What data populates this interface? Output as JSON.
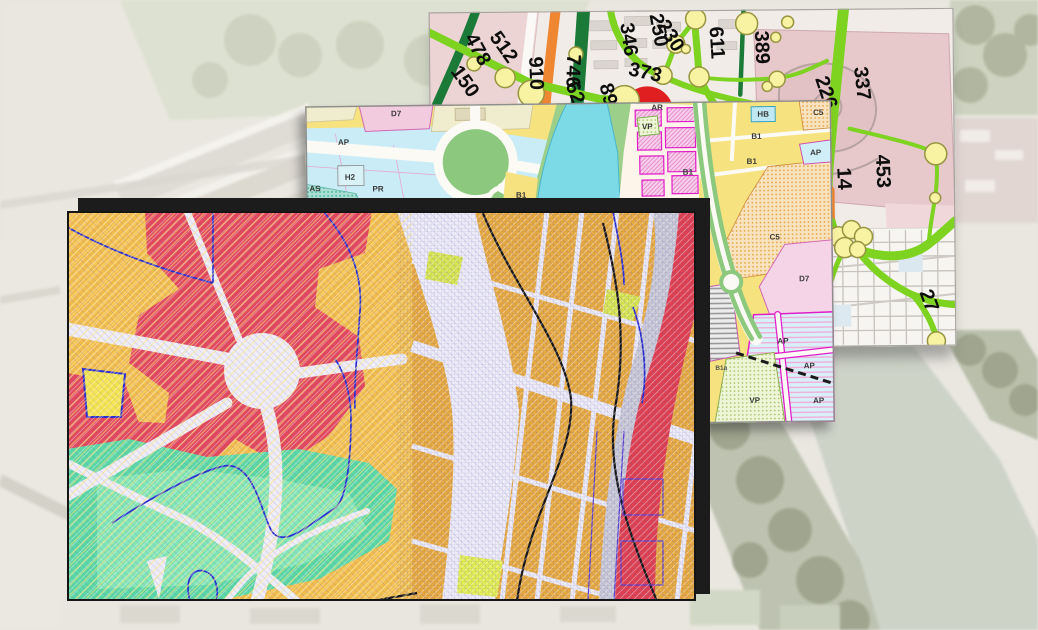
{
  "traffic_map": {
    "flow_values": [
      "478",
      "150",
      "512",
      "910",
      "89",
      "746",
      "62",
      "346",
      "373",
      "250",
      "230",
      "611",
      "389",
      "226",
      "337",
      "453",
      "14",
      "27"
    ],
    "colors": {
      "flow_bright_green": "#7ed321",
      "flow_dark_green": "#1b7a38",
      "flow_orange": "#ef8632",
      "node_fill": "#f7f3a3",
      "node_stroke": "#97953f",
      "zone_red": "#e02020",
      "block_pink": "#ecd4d4",
      "fortress_rose": "#e7c8cb",
      "background": "#f1ece8"
    }
  },
  "zoning_map": {
    "zone_labels": [
      "D7",
      "AP",
      "H2",
      "PR",
      "AS",
      "B1",
      "AR",
      "VP",
      "HB",
      "C5",
      "B1",
      "AP",
      "B1",
      "B1",
      "C5",
      "D7",
      "B1a",
      "AP",
      "AP",
      "AP",
      "VP"
    ],
    "colors": {
      "residential_yellow": "#f6e27e",
      "water_cyan": "#7cd9e6",
      "mixed_cyan": "#c9ecf6",
      "special_pink": "#f2cbdf",
      "historic_magenta": "#e01ec8",
      "green_space": "#8cc87e",
      "dotted_orange": "#f8dfb2",
      "striped_blue": "#d8f0f8",
      "dotted_teal": "#aadfd2",
      "dotted_green": "#eef5d8"
    }
  },
  "hazard_map": {
    "colors": {
      "high_risk_red": "#e2485c",
      "medium_risk_amber": "#eeb042",
      "low_risk_teal": "#5ad7a5",
      "teal_light": "#8fe9bb",
      "special_yellow_green": "#d9e74e",
      "corridor_white": "#ecebf7",
      "infrastructure_gray": "#c9c9d6",
      "contour_blue": "#2a2ecf",
      "contour_black": "#141414",
      "frame_black": "#1c1c1c"
    }
  },
  "aerial_photo": {
    "colors": {
      "base": "#e9e7de",
      "river": "#cdd3c7",
      "vegetation": "#b9bfa8",
      "buildings": "#e0dcd4"
    }
  }
}
